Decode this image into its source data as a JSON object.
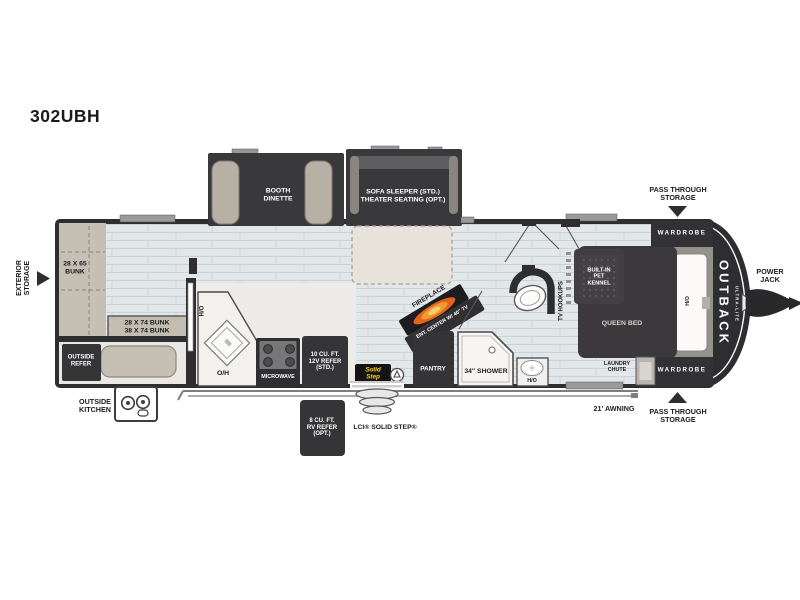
{
  "title": "302UBH",
  "brand": {
    "name": "OUTBACK",
    "sub": "ULTRA-LITE"
  },
  "exterior": {
    "storage": "EXTERIOR\nSTORAGE",
    "pass_through_top": "PASS THROUGH\nSTORAGE",
    "pass_through_bottom": "PASS THROUGH\nSTORAGE",
    "awning": "21' AWNING",
    "power_jack": "POWER\nJACK",
    "outside_kitchen": "OUTSIDE\nKITCHEN",
    "outside_refer": "OUTSIDE\nREFER",
    "lci_step": "LCI® SOLID STEP®",
    "solid_step_logo": "Solid\nStep",
    "refer_8": "8 CU. FT.\nRV REFER\n(OPT.)"
  },
  "bunkroom": {
    "bunk_vertical": "28 X 65\nBUNK",
    "bunk_horizontal": "28 X 74 BUNK\n38 X 74 BUNK"
  },
  "kitchen": {
    "hamper": "H/O",
    "overhead": "O/H",
    "microwave": "MICROWAVE",
    "refer_12v": "10 CU. FT.\n12V REFER\n(STD.)"
  },
  "living": {
    "booth_dinette": "BOOTH\nDINETTE",
    "sofa_sleeper": "SOFA SLEEPER (STD.)\nTHEATER SEATING (OPT.)",
    "fireplace": "FIREPLACE",
    "ent_center": "ENT. CENTER W/ 40\" TV",
    "pantry": "PANTRY"
  },
  "bath": {
    "shower": "34\" SHOWER",
    "water_heater": "H/O",
    "tv_hookups": "TV HOOKUPS"
  },
  "bedroom": {
    "pet_kennel": "BUILT-IN\nPET\nKENNEL",
    "queen_bed": "QUEEN BED",
    "hamper": "H/O",
    "wardrobe_top": "WARDROBE",
    "wardrobe_bottom": "WARDROBE",
    "laundry_chute": "LAUNDRY\nCHUTE"
  },
  "colors": {
    "wall": "#2e2e30",
    "furniture_dark": "#39393b",
    "floor": "#e3e7e9",
    "tan": "#c6bfb4",
    "flame": "#e2641c",
    "logo_yellow": "#f5d21b"
  }
}
